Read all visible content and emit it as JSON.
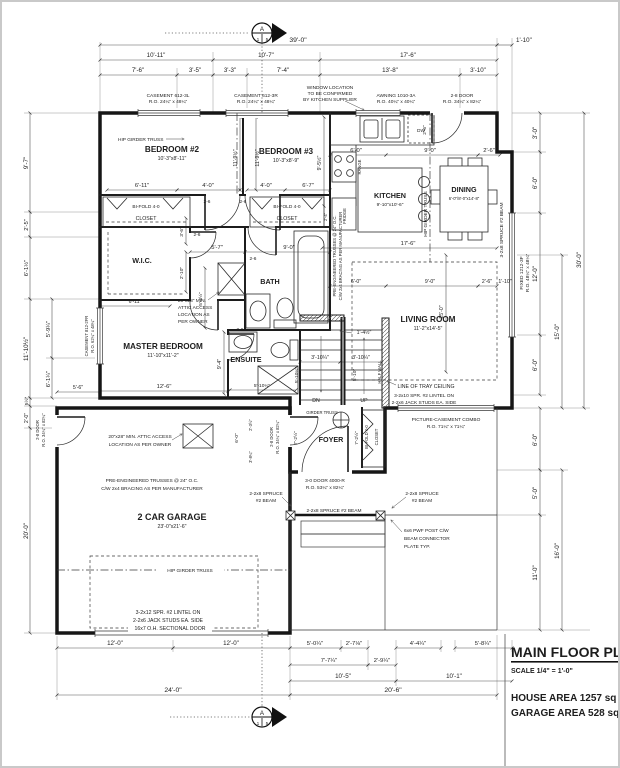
{
  "title_block": {
    "title": "MAIN FLOOR PLAN",
    "scale": "SCALE 1/4\" = 1'-0\"",
    "house_area": "HOUSE AREA 1257 sq ft.",
    "garage_area": "GARAGE AREA 528 sq ft."
  },
  "section_marker": {
    "letter": "A",
    "num": "1",
    "sheet": "5"
  },
  "rooms": {
    "bedroom2": {
      "name": "BEDROOM #2",
      "size": "10'-3\"x8'-11\""
    },
    "bedroom3": {
      "name": "BEDROOM #3",
      "size": "10'-3\"x8'-9\""
    },
    "kitchen": {
      "name": "KITCHEN",
      "size": "9'-10\"x10'-6\""
    },
    "dining": {
      "name": "DINING",
      "size": "6'-0\"/8'-0\"x14'-8\""
    },
    "living": {
      "name": "LIVING ROOM",
      "size": "11'-2\"x14'-5\""
    },
    "master": {
      "name": "MASTER BEDROOM",
      "size": "11'-10\"x11'-2\""
    },
    "garage": {
      "name": "2 CAR GARAGE",
      "size": "23'-0\"x21'-6\""
    },
    "wic": "W.I.C.",
    "bath": "BATH",
    "ensuite": "ENSUITE",
    "foyer": "FOYER"
  },
  "fixtures": {
    "dw": "DW",
    "fridge": "FRIDGE",
    "range": "RANGE",
    "dn": "DN",
    "up": "UP"
  },
  "windows": {
    "casement_l1": "CASEMENT 612-3L",
    "casement_l2": "R.O. 24¼\" x 48¼\"",
    "casement_r1": "CASEMENT 612-3R",
    "casement_r2": "R.O. 24¼\" x 48¼\"",
    "note1": "WINDOW LOCATION",
    "note2": "TO BE CONFIRMED",
    "note3": "BY KITCHEN SUPPLIER",
    "awning1": "AWNING 1010-3A",
    "awning2": "R.O. 40¼\" x 40¼\"",
    "fixed1": "FIXED 1212-3F",
    "fixed2": "R.O. 48¼\" x 48¼\"",
    "cas812_1": "CASEMENT 812-2FR",
    "cas812_2": "R.O. 62¼\" x 48¼\"",
    "picture1": "PICTURE-CASEMENT COMBO",
    "picture2": "R.O. 71¼\" x 71¼\""
  },
  "doors": {
    "d28top1": "2-8 DOOR",
    "d28top2": "R.O. 34¼\" x 82¼\"",
    "front1": "3-0 DOOR 4000-R",
    "front2": "R.O. 53¼\" x 82¼\"",
    "d28v1": "2-8 DOOR",
    "d28v2": "R.O. 34¼\" x 82¼\"",
    "overhead": "16x7 O.H. SECTIONAL DOOR",
    "bifold": "BI-FOLD 4-0",
    "closet": "CLOSET"
  },
  "notes": {
    "hip": "HIP GIRDER TRUSS",
    "girder": "GIRDER TRUSS",
    "attic1a": "20\"x28\" MIN.",
    "attic1b": "ATTIC ACCESS",
    "attic1c": "LOCATION AS",
    "attic1d": "PER OWNER",
    "attic2a": "20\"x28\" MIN. ATTIC ACCESS",
    "attic2b": "LOCATION AS PER OWNER",
    "trussa": "PRE-ENGINEERED TRUSSES @ 24\" O.C.",
    "trussb": "C/W 2x4 BRACING AS PER MANUFACTURER",
    "tray": "LINE OF TRAY CEILING",
    "lintel1a": "3-2x10 SPR. #2 LINTEL ON",
    "lintel1b": "2-2x6 JACK STUDS EA. SIDE",
    "lintel2a": "3-2x12 SPR. #2 LINTEL ON",
    "lintel2b": "2-2x6 JACK STUDS EA. SIDE",
    "beam2a": "2-2x8 SPRUCE",
    "beam2b": "#2 BEAM",
    "beam2line": "2-2x8 SPRUCE #2 BEAM",
    "beam3": "3-2x8 SPRUCE #2 BEAM",
    "posta": "6x6 PWF POST C/W",
    "postb": "BEAM CONNECTOR",
    "postc": "PLATE TYP.",
    "halfwall": "HALF WALL"
  },
  "dims": {
    "t0": "39'-0\"",
    "t0r": "1'-10\"",
    "t2a": "10'-11\"",
    "t2b": "10'-7\"",
    "t2c": "17'-6\"",
    "t3a": "7'-6\"",
    "t3b": "3'-5\"",
    "t3c": "3'-3\"",
    "t3d": "7'-4\"",
    "t3e": "13'-8\"",
    "t3f": "3'-10\"",
    "r1": "3'-0\"",
    "r2": "6'-0\"",
    "r3": "12'-0\"",
    "r4": "6'-0\"",
    "r5": "15'-0\"",
    "r6": "30'-0\"",
    "rl1": "6'-0\"",
    "rl2": "5'-0\"",
    "rl3": "11'-0\"",
    "rl4": "16'-0\"",
    "l1": "9'-7\"",
    "l2": "2'-5\"",
    "l3": "6'-1½\"",
    "l4": "11'-10½\"",
    "l5": "5'-9¼\"",
    "l6": "6'-1¼\"",
    "ll1": "5½\"",
    "ll2": "2'-0\"",
    "ll3": "20'-0\"",
    "b1a": "12'-0\"",
    "b1b": "12'-0\"",
    "b1c": "5'-0¼\"",
    "b1d": "2'-7⅛\"",
    "b1e": "4'-4¼\"",
    "b1f": "5'-8¼\"",
    "b2a": "7'-7¼\"",
    "b2b": "2'-9¼\"",
    "b3a": "10'-5\"",
    "b3b": "10'-1\"",
    "b4a": "24'-0\"",
    "b4b": "20'-6\"",
    "bed1": "6'-11\"",
    "bed2": "4'-0\"",
    "bed3": "4'-0\"",
    "bed4": "6'-7\"",
    "vbed": "11'-9½\"",
    "vkit": "9'-5½\"",
    "k1": "6'-0\"",
    "k2": "9'-0\"",
    "k3": "2'-6\"",
    "k4": "1'-10\"",
    "liv17": "17'-6\"",
    "v25": "25'-0\"",
    "hall1": "5'-7\"",
    "hall2": "9'-0\"",
    "d26": "2-6",
    "v36": "3'-6\"",
    "v210": "2'-10\"",
    "v544": "5'-4½\"",
    "v94": "9'-4\"",
    "v24": "2'-4\"",
    "v26": "2'-6\"",
    "m611": "6'-11\"",
    "m126": "12'-6\"",
    "m56": "5'-6\"",
    "ens": "5'-10¼\"",
    "st1": "3'-10¼\"",
    "st2": "3'-10¼\"",
    "vst1": "5'-10¼\"",
    "vst2": "5'-10\"",
    "d144": "1'-4½\"",
    "foy72": "7'-2½\"",
    "foy60": "6'-0\"",
    "foy38": "3'-8¼\"",
    "foy23": "2'-3½\""
  }
}
